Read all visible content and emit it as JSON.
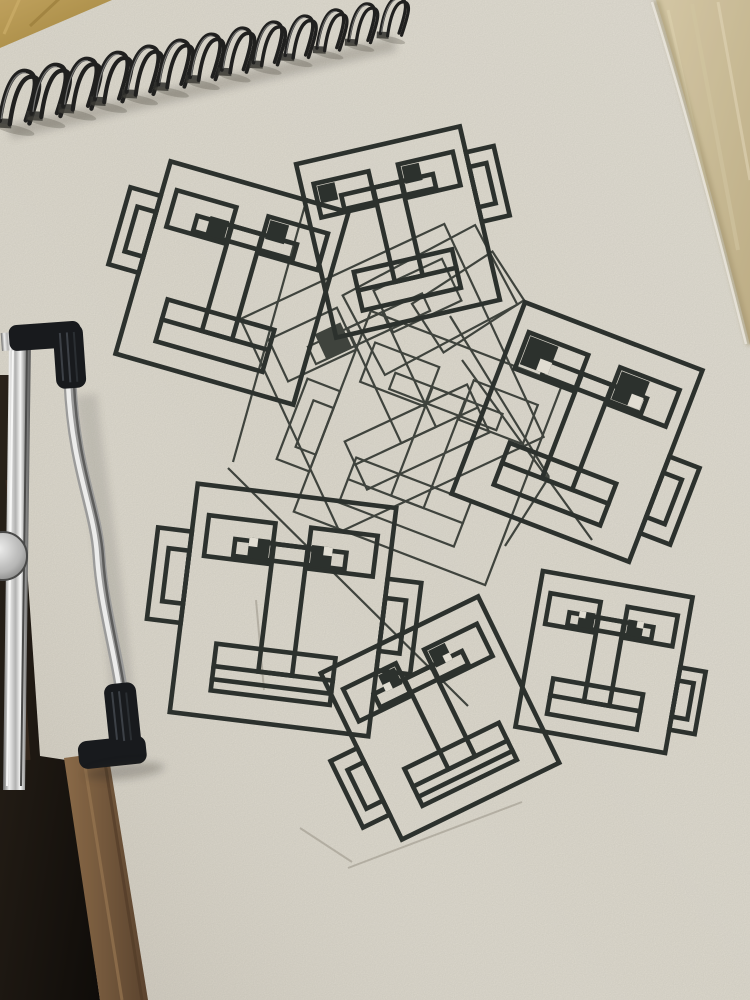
{
  "scene": {
    "subject": "photo of a spiral-bound sketchpad on a wooden desk, held by a metal easel clamp, with overlapping square cartoon faces drawn in ink",
    "face_count": 9
  },
  "palette": {
    "paper": "#e7e3d8",
    "ink": "#2c312e",
    "ghost_ink": "#3f443e",
    "wood_top_left": "#b99755",
    "wood_top_right": "#cfc2a0",
    "wood_strip": "#7d5f42",
    "dark_shadow": "#17120e",
    "wire": "#1f1f1f",
    "chrome": "#c9c9c9",
    "rubber_cap": "#17191d"
  },
  "notebook": {
    "paper_color": "#e7e3d8",
    "spiral": {
      "count": 13,
      "x1": 16,
      "y1": 116,
      "x2": 392,
      "y2": 30,
      "lean_deg": 13,
      "wire_color": "#1f1f1f"
    },
    "paper_edge_top_right": [
      [
        656,
        0
      ],
      [
        750,
        345
      ]
    ],
    "paper_edge_bottom_left": [
      [
        40,
        756
      ],
      [
        104,
        1000
      ]
    ]
  },
  "clamp": {
    "vertical_bar": [
      [
        9,
        340
      ],
      [
        31,
        340
      ],
      [
        25,
        790
      ],
      [
        3,
        790
      ]
    ],
    "rod": "M70,382 C74,470 96,508 99,556 C102,604 116,650 122,694",
    "top_cap": {
      "x": 12,
      "y": 323
    },
    "bottom_cap": {
      "x": 80,
      "y": 686
    },
    "disc": {
      "cx": 3,
      "cy": 556,
      "r": 24
    }
  },
  "drawing": {
    "ink_color": "#2c312e",
    "ghost_ink_color": "#3f443e",
    "bold_stroke": 4.6,
    "thin_stroke": 2.2,
    "faces": [
      {
        "id": "top-left",
        "cx": 232,
        "cy": 283,
        "w": 185,
        "h": 200,
        "rot": 16,
        "weight": "bold",
        "ears": [
          {
            "side": -1,
            "y": -0.12
          }
        ],
        "pupils": [
          {
            "eye": 0,
            "corner": "br"
          },
          {
            "eye": 1,
            "corner": "tl"
          }
        ],
        "bands": 1
      },
      {
        "id": "top-center",
        "cx": 398,
        "cy": 232,
        "w": 168,
        "h": 178,
        "rot": -13,
        "weight": "bold",
        "ears": [
          {
            "side": 1,
            "y": -0.15
          }
        ],
        "pupils": [
          {
            "eye": 0,
            "corner": "tl"
          },
          {
            "eye": 1,
            "corner": "tl"
          }
        ],
        "bands": 1
      },
      {
        "id": "right",
        "cx": 577,
        "cy": 432,
        "w": 190,
        "h": 205,
        "rot": 21,
        "weight": "bold",
        "ears": [
          {
            "side": 1,
            "y": 0.15
          }
        ],
        "pupils": [
          {
            "eye": 0,
            "corner": "tl",
            "scale": 1.5,
            "notch": true
          },
          {
            "eye": 1,
            "corner": "tl",
            "scale": 1.5,
            "notch": true
          }
        ],
        "bands": 1
      },
      {
        "id": "mid-left",
        "cx": 283,
        "cy": 610,
        "w": 200,
        "h": 230,
        "rot": 7,
        "weight": "bold",
        "ears": [
          {
            "side": -1,
            "y": -0.09
          },
          {
            "side": 1,
            "y": 0.01
          }
        ],
        "pupils": [
          {
            "eye": 0,
            "corner": "br",
            "notch": true
          },
          {
            "eye": 1,
            "corner": "bl",
            "notch": true
          }
        ],
        "bands": 2
      },
      {
        "id": "bottom-center",
        "cx": 440,
        "cy": 718,
        "w": 175,
        "h": 185,
        "rot": -26,
        "weight": "bold",
        "ears": [
          {
            "side": -1,
            "y": 0.15
          }
        ],
        "pupils": [
          {
            "eye": 0,
            "corner": "tr",
            "notch": true
          },
          {
            "eye": 1,
            "corner": "tl",
            "notch": true
          }
        ],
        "bands": 2
      },
      {
        "id": "bottom-right",
        "cx": 604,
        "cy": 662,
        "w": 152,
        "h": 158,
        "rot": 10,
        "weight": "bold",
        "ears": [
          {
            "side": 1,
            "y": 0.15
          }
        ],
        "pupils": [
          {
            "eye": 0,
            "corner": "br",
            "notch": true
          },
          {
            "eye": 1,
            "corner": "bl",
            "notch": true
          }
        ],
        "bands": 1
      },
      {
        "id": "ghost-a",
        "cx": 392,
        "cy": 378,
        "w": 225,
        "h": 235,
        "rot": -25,
        "weight": "thin",
        "ears": [],
        "pupils": [
          {
            "eye": 0,
            "corner": "br",
            "scale": 1.2
          }
        ],
        "bands": 1
      },
      {
        "id": "ghost-b",
        "cx": 428,
        "cy": 448,
        "w": 205,
        "h": 215,
        "rot": 21,
        "weight": "thin",
        "ears": [
          {
            "side": -1,
            "y": 0.1
          }
        ],
        "pupils": [],
        "bands": 1
      }
    ],
    "ghost_rects": [
      {
        "cx": 430,
        "cy": 300,
        "w": 150,
        "h": 90,
        "rot": -28
      },
      {
        "cx": 468,
        "cy": 302,
        "w": 96,
        "h": 58,
        "rot": -33
      }
    ],
    "stray_lines": [
      [
        450,
        316,
        549,
        477
      ],
      [
        549,
        477,
        505,
        546
      ],
      [
        462,
        360,
        592,
        540
      ],
      [
        228,
        468,
        468,
        706
      ],
      [
        307,
        198,
        233,
        462
      ]
    ],
    "pencil_lines": [
      [
        348,
        868,
        522,
        802
      ],
      [
        300,
        828,
        352,
        862
      ],
      [
        256,
        600,
        264,
        690
      ]
    ]
  }
}
